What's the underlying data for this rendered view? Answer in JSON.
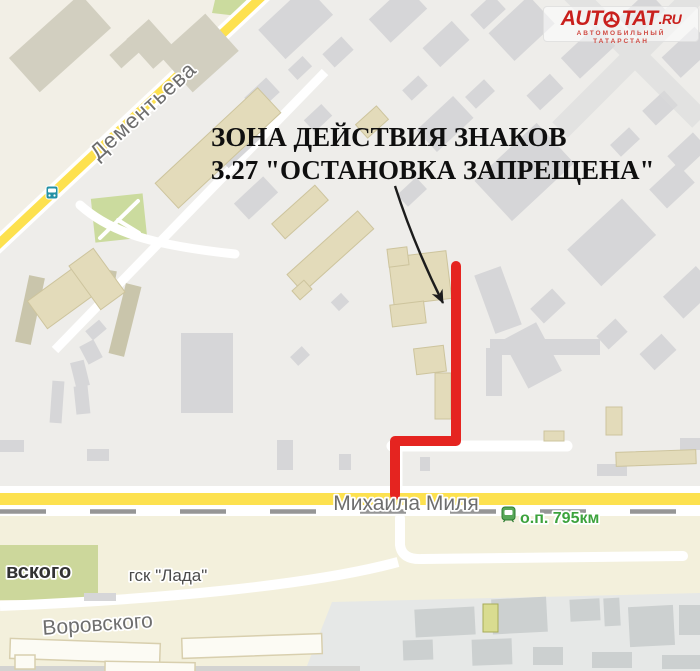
{
  "annotation": {
    "line1": "ЗОНА ДЕЙСТВИЯ ЗНАКОВ",
    "line2": "3.27 \"ОСТАНОВКА ЗАПРЕЩЕНА\""
  },
  "labels": {
    "street_dementyeva": "Дементьева",
    "street_mikhaila_milya": "Михаила Миля",
    "street_vorovskogo": "Воровского",
    "street_partial": "вского",
    "gsk_lada": "гск \"Лада\"",
    "rail_stop": "о.п. 795км"
  },
  "logo": {
    "name_left": "AUT",
    "name_right": "TAT",
    "tld": ".RU",
    "tagline": "АВТОМОБИЛЬНЫЙ ТАТАРСТАН"
  },
  "colors": {
    "map_bg": "#eeedea",
    "cream_zone": "#f2efe6",
    "bottom_cream": "#f3f0dc",
    "bottom_gray_zone": "#e6e8e7",
    "building_gray": "#d6d6d8",
    "building_gray_dark": "#ccd0d0",
    "building_tan": "#e3dbba",
    "building_tan_dark": "#c9c5ab",
    "building_topleft": "#d2cfc0",
    "garage_white": "#fcfbf4",
    "garage_stroke": "#d8cfae",
    "road_yellow": "#fde14f",
    "road_white": "#ffffff",
    "rail_gray": "#969696",
    "green_area": "#cbdb9e",
    "green_area_bottom": "#ccd79b",
    "red_zone": "#e52420",
    "arrow_black": "#1c1c1c",
    "label_gray": "#6e6e6e",
    "label_green": "#3da33d",
    "annotation_black": "#0f0f0f",
    "logo_red": "#c9201d",
    "transit_teal": "#2491a5",
    "watermark_gray": "#dadada"
  }
}
